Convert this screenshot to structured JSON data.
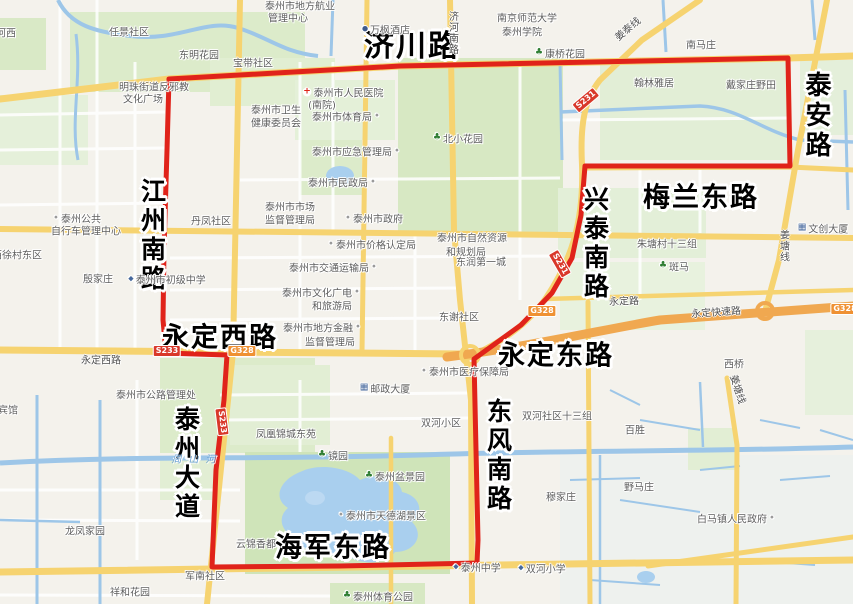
{
  "boundary": {
    "color": "#e0231a",
    "width": 5,
    "path": "M169,79 L400,66 L788,58 L790,166 L585,166 L581,215 L572,258 L552,293 L521,325 L492,346 L474,359 L476,450 L478,540 L477,563 L340,566 L212,567 L216,470 L224,400 L227,355 L166,353 L163,320 L164,250 L167,150 Z"
  },
  "major_road_labels": [
    {
      "text": "济川路",
      "x": 412,
      "y": 47,
      "dir": "h",
      "size": 30
    },
    {
      "text": "泰安路",
      "x": 816,
      "y": 116,
      "dir": "v",
      "size": 26
    },
    {
      "text": "江州南路",
      "x": 152,
      "y": 236,
      "dir": "v",
      "size": 25
    },
    {
      "text": "兴泰南路",
      "x": 595,
      "y": 244,
      "dir": "v",
      "size": 25
    },
    {
      "text": "梅兰东路",
      "x": 701,
      "y": 198,
      "dir": "h",
      "size": 27
    },
    {
      "text": "永定西路",
      "x": 220,
      "y": 338,
      "dir": "h",
      "size": 27
    },
    {
      "text": "永定东路",
      "x": 556,
      "y": 356,
      "dir": "h",
      "size": 27
    },
    {
      "text": "泰州大道",
      "x": 186,
      "y": 464,
      "dir": "v",
      "size": 25
    },
    {
      "text": "东风南路",
      "x": 498,
      "y": 456,
      "dir": "v",
      "size": 25
    },
    {
      "text": "海军东路",
      "x": 333,
      "y": 548,
      "dir": "h",
      "size": 27
    }
  ],
  "poi_labels": [
    {
      "text": "任景社区",
      "x": 129,
      "y": 31
    },
    {
      "text": "河西",
      "x": 6,
      "y": 32
    },
    {
      "text": "泰州市地方航业",
      "x": 300,
      "y": 5
    },
    {
      "text": "管理中心",
      "x": 288,
      "y": 17
    },
    {
      "text": "东明花园",
      "x": 199,
      "y": 54
    },
    {
      "text": "宝带社区",
      "x": 253,
      "y": 62
    },
    {
      "text": "明珠街道反邪教",
      "x": 154,
      "y": 86
    },
    {
      "text": "文化广场",
      "x": 143,
      "y": 98
    },
    {
      "text": "万枫酒店",
      "x": 386,
      "y": 29,
      "icon": "hotel"
    },
    {
      "text": "南京师范大学",
      "x": 527,
      "y": 17
    },
    {
      "text": "泰州学院",
      "x": 522,
      "y": 31
    },
    {
      "text": "康桥花园",
      "x": 560,
      "y": 53,
      "icon": "tree"
    },
    {
      "text": "南马庄",
      "x": 701,
      "y": 44
    },
    {
      "text": "翰林雅居",
      "x": 654,
      "y": 82
    },
    {
      "text": "戴家庄野田",
      "x": 751,
      "y": 84
    },
    {
      "text": "泰州市卫生",
      "x": 276,
      "y": 109
    },
    {
      "text": "健康委员会",
      "x": 276,
      "y": 122
    },
    {
      "text": "泰州市人民医院",
      "x": 343,
      "y": 92,
      "icon": "hospital"
    },
    {
      "text": "(南院)",
      "x": 322,
      "y": 104
    },
    {
      "text": "泰州市体育局",
      "x": 346,
      "y": 116,
      "icon": "dot",
      "side": "r"
    },
    {
      "text": "北小花园",
      "x": 458,
      "y": 138,
      "icon": "tree"
    },
    {
      "text": "泰州市应急管理局",
      "x": 356,
      "y": 151,
      "icon": "dot",
      "side": "r"
    },
    {
      "text": "泰州市民政局",
      "x": 342,
      "y": 182,
      "icon": "dot",
      "side": "r"
    },
    {
      "text": "丹凤社区",
      "x": 211,
      "y": 220
    },
    {
      "text": "泰州市市场",
      "x": 290,
      "y": 206
    },
    {
      "text": "监督管理局",
      "x": 290,
      "y": 219
    },
    {
      "text": "泰州市政府",
      "x": 374,
      "y": 218,
      "icon": "dot"
    },
    {
      "text": "泰州市价格认定局",
      "x": 372,
      "y": 244,
      "icon": "dot"
    },
    {
      "text": "泰州市自然资源",
      "x": 472,
      "y": 237
    },
    {
      "text": "和规划局",
      "x": 466,
      "y": 251
    },
    {
      "text": "东润第一城",
      "x": 481,
      "y": 261
    },
    {
      "text": "泰州市交通运输局",
      "x": 333,
      "y": 267,
      "icon": "dot",
      "side": "r"
    },
    {
      "text": "朱塘村十三组",
      "x": 667,
      "y": 243
    },
    {
      "text": "斑马",
      "x": 674,
      "y": 266,
      "icon": "tree"
    },
    {
      "text": "泰州市初级中学",
      "x": 167,
      "y": 279,
      "icon": "school"
    },
    {
      "text": "殷家庄",
      "x": 98,
      "y": 278
    },
    {
      "text": "泰州公共",
      "x": 77,
      "y": 218,
      "icon": "dot"
    },
    {
      "text": "自行车管理中心",
      "x": 86,
      "y": 230
    },
    {
      "text": "西徐村东区",
      "x": 17,
      "y": 254
    },
    {
      "text": "东谢社区",
      "x": 459,
      "y": 316
    },
    {
      "text": "泰州市文化广电",
      "x": 321,
      "y": 292,
      "icon": "dot",
      "side": "r"
    },
    {
      "text": "和旅游局",
      "x": 332,
      "y": 305
    },
    {
      "text": "泰州市地方金融",
      "x": 322,
      "y": 327,
      "icon": "dot",
      "side": "r"
    },
    {
      "text": "监督管理局",
      "x": 330,
      "y": 341
    },
    {
      "text": "泰州市医疗保障局",
      "x": 465,
      "y": 371,
      "icon": "dot"
    },
    {
      "text": "邮政大厦",
      "x": 385,
      "y": 388,
      "icon": "building"
    },
    {
      "text": "双河小区",
      "x": 441,
      "y": 422
    },
    {
      "text": "双河社区十三组",
      "x": 557,
      "y": 415
    },
    {
      "text": "西桥",
      "x": 734,
      "y": 363
    },
    {
      "text": "百胜",
      "x": 635,
      "y": 429
    },
    {
      "text": "野马庄",
      "x": 639,
      "y": 486
    },
    {
      "text": "穆家庄",
      "x": 561,
      "y": 496
    },
    {
      "text": "白马镇人民政府",
      "x": 736,
      "y": 518,
      "icon": "dot",
      "side": "r"
    },
    {
      "text": "凤凰锦城东苑",
      "x": 286,
      "y": 433
    },
    {
      "text": "镜园",
      "x": 333,
      "y": 455,
      "icon": "tree"
    },
    {
      "text": "泰州盆景园",
      "x": 395,
      "y": 476,
      "icon": "tree"
    },
    {
      "text": "泰州市天德湖景区",
      "x": 382,
      "y": 515,
      "icon": "dot"
    },
    {
      "text": "云锦香都",
      "x": 256,
      "y": 543
    },
    {
      "text": "泰州中学",
      "x": 477,
      "y": 567,
      "icon": "school"
    },
    {
      "text": "双河小学",
      "x": 542,
      "y": 568,
      "icon": "school"
    },
    {
      "text": "泰州体育公园",
      "x": 378,
      "y": 596,
      "icon": "tree"
    },
    {
      "text": "军南社区",
      "x": 205,
      "y": 575
    },
    {
      "text": "祥和花园",
      "x": 130,
      "y": 591
    },
    {
      "text": "龙凤家园",
      "x": 85,
      "y": 530
    },
    {
      "text": "泰州市公路管理处",
      "x": 156,
      "y": 394
    },
    {
      "text": "宾馆",
      "x": 8,
      "y": 409
    },
    {
      "text": "文创大厦",
      "x": 823,
      "y": 228,
      "icon": "building"
    }
  ],
  "onroad_labels": [
    {
      "text": "永定西路",
      "x": 101,
      "y": 359
    },
    {
      "text": "永定路",
      "x": 624,
      "y": 300,
      "rot": -2
    },
    {
      "text": "永定快速路",
      "x": 716,
      "y": 311,
      "rot": -4
    },
    {
      "text": "济河南路",
      "x": 452,
      "y": 33,
      "dir": "v"
    },
    {
      "text": "姜泰线",
      "x": 627,
      "y": 28,
      "rot": -40
    },
    {
      "text": "姜塘线",
      "x": 783,
      "y": 246,
      "dir": "v"
    },
    {
      "text": "姜塘线",
      "x": 739,
      "y": 389,
      "rot": 72
    }
  ],
  "badges": [
    {
      "text": "S231",
      "x": 586,
      "y": 100,
      "rot": -40,
      "type": "s"
    },
    {
      "text": "S231",
      "x": 560,
      "y": 264,
      "rot": 60,
      "type": "s"
    },
    {
      "text": "S233",
      "x": 167,
      "y": 351,
      "rot": 0,
      "type": "s"
    },
    {
      "text": "S233",
      "x": 222,
      "y": 422,
      "rot": 83,
      "type": "s"
    },
    {
      "text": "G328",
      "x": 242,
      "y": 351,
      "rot": 0,
      "type": "g"
    },
    {
      "text": "G328",
      "x": 542,
      "y": 311,
      "rot": 0,
      "type": "g"
    },
    {
      "text": "G328",
      "x": 845,
      "y": 309,
      "rot": 0,
      "type": "g"
    }
  ],
  "water_labels": [
    {
      "text": "周山河",
      "x": 197,
      "y": 458
    }
  ]
}
